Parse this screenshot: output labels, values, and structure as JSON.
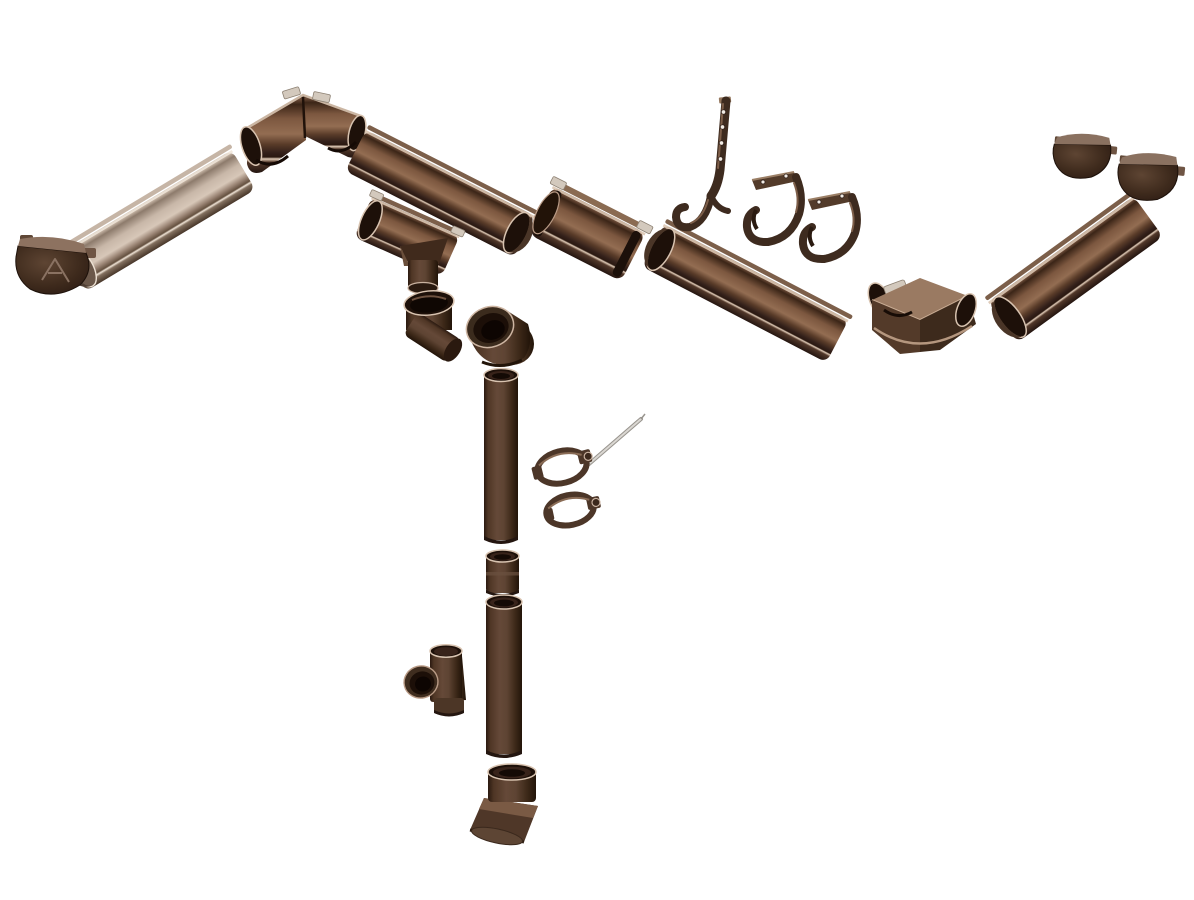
{
  "scene": {
    "description": "Exploded product view of a brown half-round rain gutter and downpipe system on a white background: end caps, gutter sections, 90-degree internal and external corners, union connector with seals, outlet funnel, rafter hook, fascia brackets, downpipes, elbows, clamps with fixing screw, tee branch and outlet shoe"
  },
  "palette": {
    "background": "#ffffff",
    "brown_darkest": "#241510",
    "brown_dark": "#3a261a",
    "brown_mid": "#5f4432",
    "brown_light": "#8b6750",
    "tan_highlight": "#d8c4b2",
    "metal_clip": "#d3c9bd",
    "screw_metal": "#dad7d2"
  },
  "parts": {
    "end_cap_left": {
      "label": "Gutter end cap (left) with embossed brand logo"
    },
    "gutter_section_left": {
      "label": "Half-round gutter section, left run"
    },
    "corner_internal": {
      "label": "Gutter 90-degree internal corner with seals and clips"
    },
    "gutter_section_upper": {
      "label": "Half-round gutter section"
    },
    "gutter_outlet": {
      "label": "Gutter outlet funnel to downpipe"
    },
    "pipe_elbow_1": {
      "label": "Downpipe elbow bend"
    },
    "pipe_elbow_2": {
      "label": "Downpipe elbow bend"
    },
    "gutter_union": {
      "label": "Gutter union joint connector with rubber seals"
    },
    "gutter_section_main": {
      "label": "Half-round gutter section, main run"
    },
    "rafter_hook": {
      "label": "Long rafter gutter hook with screw holes"
    },
    "gutter_bracket_1": {
      "label": "Gutter fascia bracket hook"
    },
    "gutter_bracket_2": {
      "label": "Gutter fascia bracket hook"
    },
    "corner_external": {
      "label": "Gutter 90-degree external corner"
    },
    "gutter_section_right": {
      "label": "Half-round gutter section, right run"
    },
    "end_cap_right_1": {
      "label": "Gutter end cap"
    },
    "end_cap_right_2": {
      "label": "Gutter end cap"
    },
    "downpipe_upper": {
      "label": "Downpipe tube, upper"
    },
    "pipe_clamp_1": {
      "label": "Downpipe clamp with fixing screw"
    },
    "fixing_screw": {
      "label": "Long clamp fixing screw"
    },
    "pipe_clamp_2": {
      "label": "Downpipe clamp"
    },
    "pipe_coupler": {
      "label": "Downpipe coupler socket"
    },
    "downpipe_lower": {
      "label": "Downpipe tube, lower"
    },
    "pipe_tee": {
      "label": "Downpipe tee branch connector"
    },
    "pipe_shoe": {
      "label": "Downpipe outlet shoe elbow"
    }
  }
}
